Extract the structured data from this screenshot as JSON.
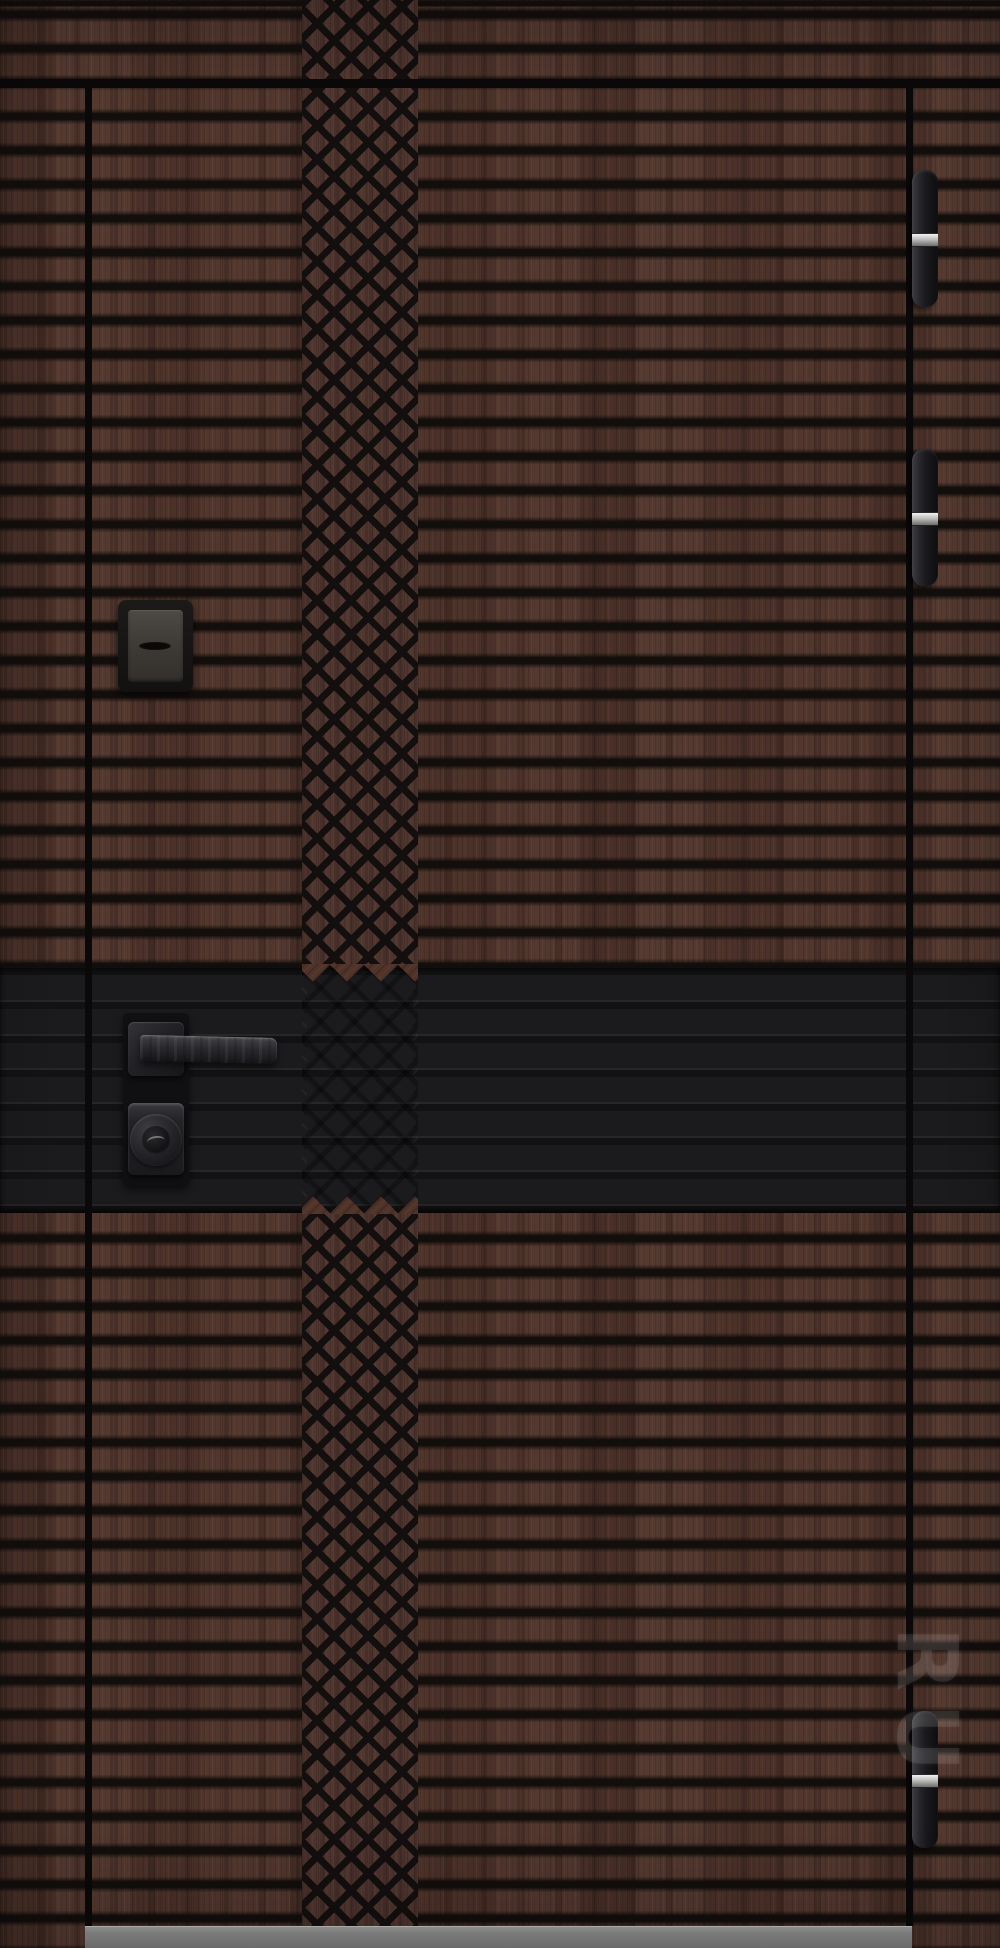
{
  "photo": {
    "subject": "entrance-door-product-photo",
    "finish": "dark brown woodgrain with horizontal slat grooves",
    "decor": "central vertical diamond lattice milling",
    "watermark_text": "RU"
  },
  "door": {
    "slat_groove_color": "#120e0c",
    "wood_color": "#4f342b",
    "mid_band_color": "#1b1b1e",
    "threshold_color": "#909090",
    "hinge_count": 3,
    "hinge_color": "#19191d",
    "hinge_pin_color": "#bdbdbb",
    "hardware_color": "#1a1a1d",
    "hardware_items": [
      "upper-lock-cover",
      "lever-handle",
      "cylinder-lock"
    ]
  }
}
